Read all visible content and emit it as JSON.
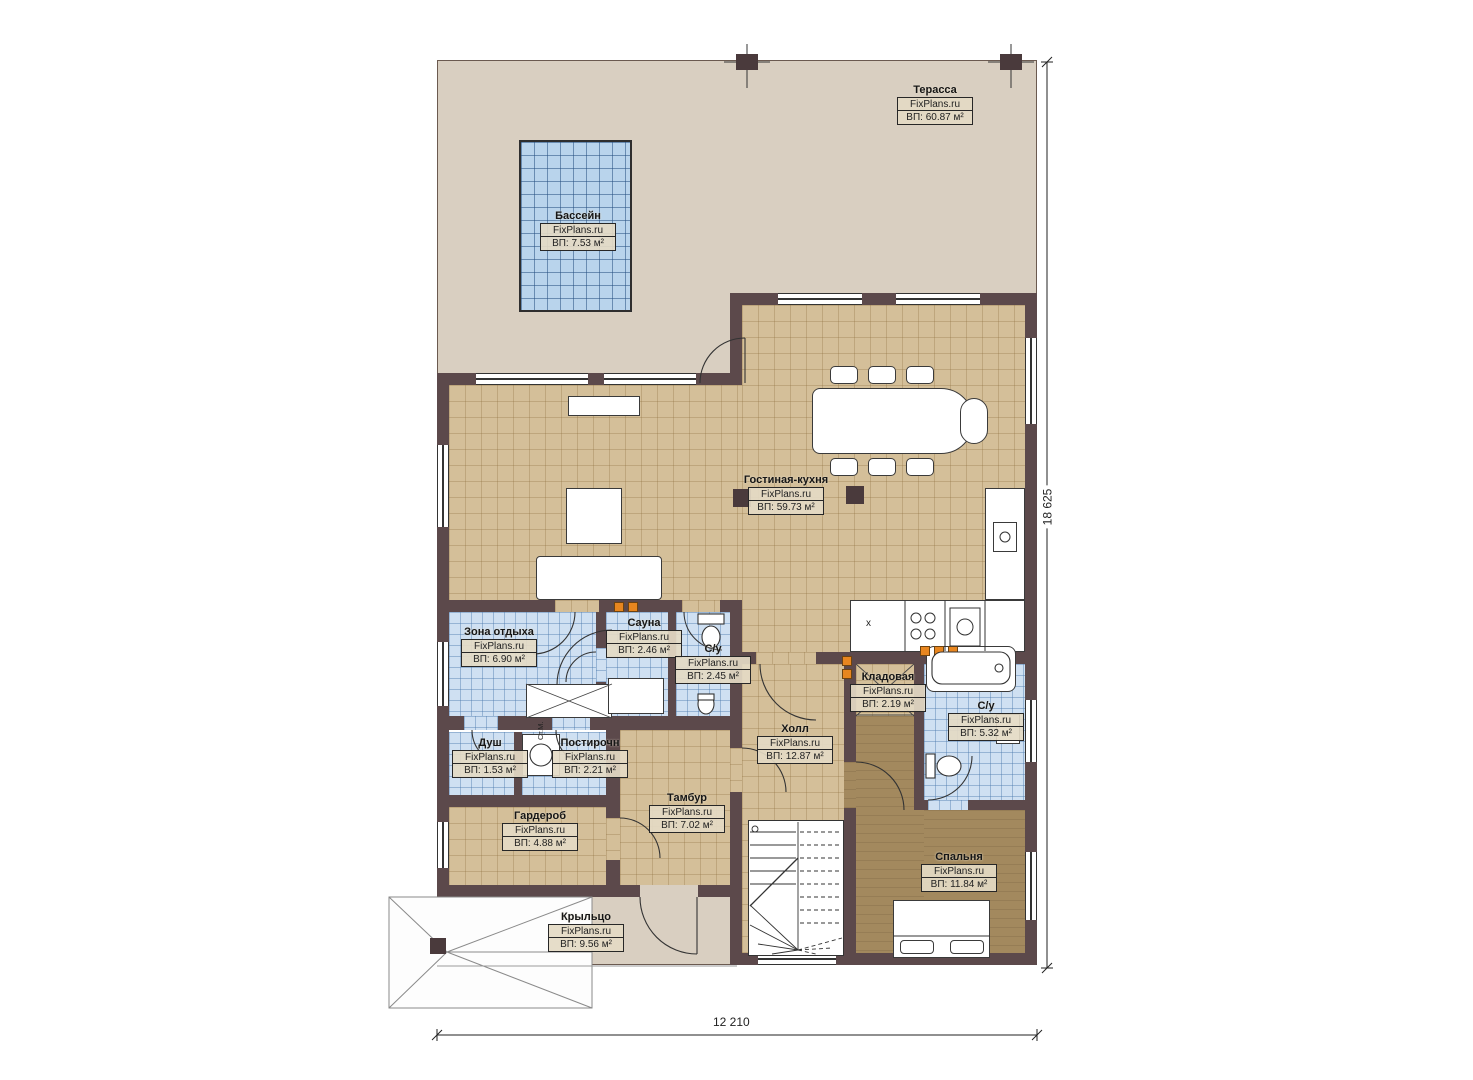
{
  "watermark": "FixPlans.ru",
  "dimensions": {
    "height_label": "18 625",
    "width_label": "12 210"
  },
  "rooms": [
    {
      "id": "terrace",
      "name": "Терасса",
      "area": "ВП: 60.87 м²"
    },
    {
      "id": "pool",
      "name": "Бассейн",
      "area": "ВП: 7.53 м²"
    },
    {
      "id": "living",
      "name": "Гостиная-кухня",
      "area": "ВП: 59.73 м²"
    },
    {
      "id": "lounge",
      "name": "Зона отдыха",
      "area": "ВП: 6.90 м²"
    },
    {
      "id": "sauna",
      "name": "Сауна",
      "area": "ВП: 2.46 м²"
    },
    {
      "id": "wc1",
      "name": "С/у",
      "area": "ВП: 2.45 м²"
    },
    {
      "id": "shower",
      "name": "Душ",
      "area": "ВП: 1.53 м²"
    },
    {
      "id": "laundry",
      "name": "Постирочн",
      "area": "ВП: 2.21 м²"
    },
    {
      "id": "wardrobe",
      "name": "Гардероб",
      "area": "ВП: 4.88 м²"
    },
    {
      "id": "vestibule",
      "name": "Тамбур",
      "area": "ВП: 7.02 м²"
    },
    {
      "id": "hall",
      "name": "Холл",
      "area": "ВП: 12.87 м²"
    },
    {
      "id": "storage",
      "name": "Кладовая",
      "area": "ВП: 2.19 м²"
    },
    {
      "id": "bath",
      "name": "С/у",
      "area": "ВП: 5.32 м²"
    },
    {
      "id": "bedroom",
      "name": "Спальня",
      "area": "ВП: 11.84 м²"
    },
    {
      "id": "porch",
      "name": "Крыльцо",
      "area": "ВП: 9.56 м²"
    }
  ],
  "annotations": {
    "washing_machine": "Ст.М.",
    "fridge": "x"
  },
  "colors": {
    "wall": "#5c494b",
    "terrace_floor": "#d9cfc1",
    "tile_tan": "#d4bf99",
    "tile_blue": "#cfe0f2",
    "wood_floor": "#a3895e",
    "pool_water": "#b9d4ec",
    "marker_orange": "#e8861f"
  }
}
